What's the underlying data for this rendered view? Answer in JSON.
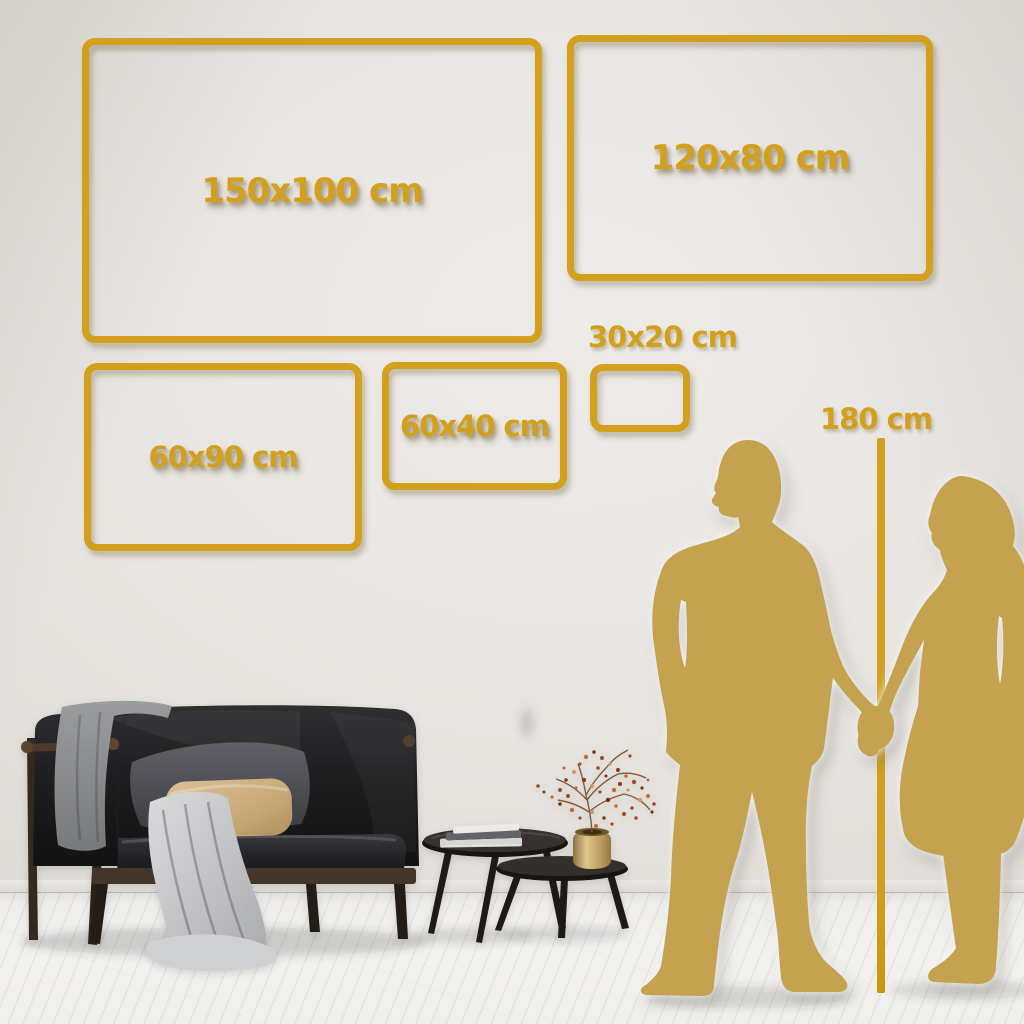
{
  "guide": {
    "sizes": [
      {
        "id": "150x100",
        "label": "150x100 cm"
      },
      {
        "id": "120x80",
        "label": "120x80 cm"
      },
      {
        "id": "60x90",
        "label": "60x90 cm"
      },
      {
        "id": "60x40",
        "label": "60x40 cm"
      },
      {
        "id": "30x20",
        "label": "30x20 cm"
      }
    ],
    "height_reference": {
      "label": "180 cm"
    }
  },
  "colors": {
    "accent_gold": "#d2a01d",
    "silhouette_gold": "#c5a250",
    "wall": "#e7e4e0",
    "floor": "#f1f0ee"
  }
}
